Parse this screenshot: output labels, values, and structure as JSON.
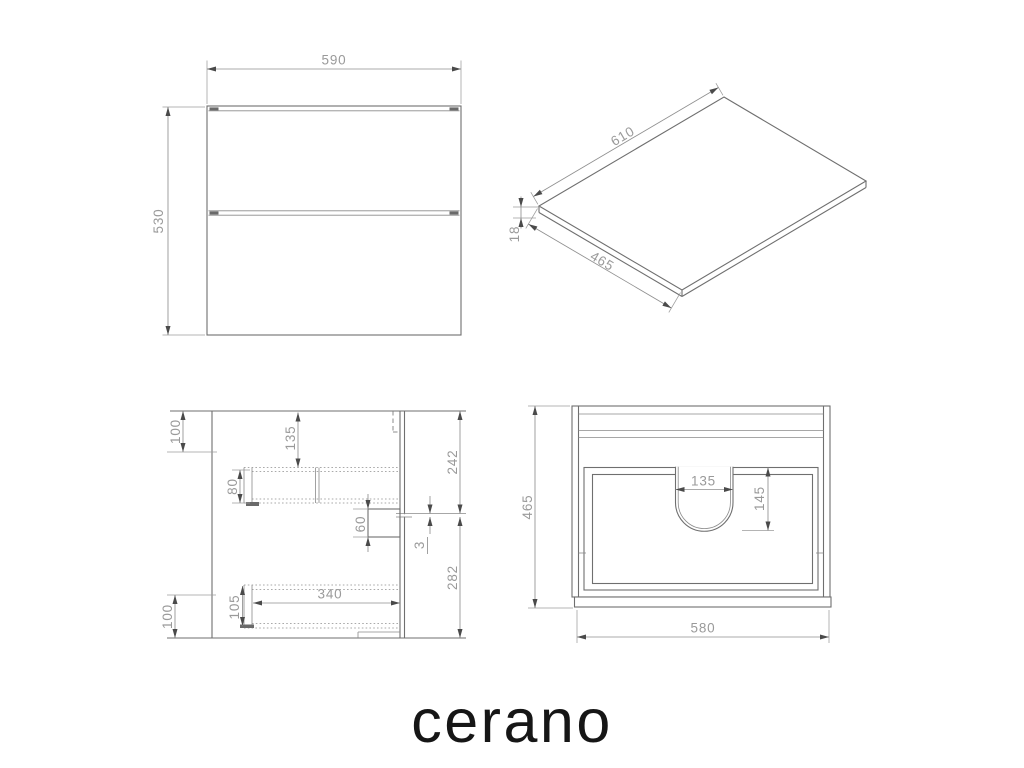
{
  "page": {
    "background": "#ffffff"
  },
  "brand": {
    "logo": "cerano",
    "logo_color": "#161616"
  },
  "drawing": {
    "line_color": "#6f6f6f",
    "dim_text_color": "#9a9a9a",
    "views": {
      "front": {
        "label": "front view of vanity cabinet",
        "dims": {
          "width": "590",
          "height": "530"
        }
      },
      "countertop": {
        "label": "countertop isometric view",
        "dims": {
          "length": "610",
          "depth": "465",
          "thickness": "18"
        }
      },
      "side": {
        "label": "side cross-section view",
        "dims": {
          "top_offset": "100",
          "rail_from_top": "135",
          "rail_height": "80",
          "bracket_height": "60",
          "upper_back_height": "242",
          "panel_gap": "3",
          "lower_back_height": "282",
          "lower_rail_length": "340",
          "lower_rail_height": "105",
          "bottom_offset": "100"
        }
      },
      "plan": {
        "label": "top plan view",
        "dims": {
          "depth": "465",
          "sink_cutout_width": "135",
          "sink_cutout_depth": "145",
          "width": "580"
        }
      }
    }
  }
}
